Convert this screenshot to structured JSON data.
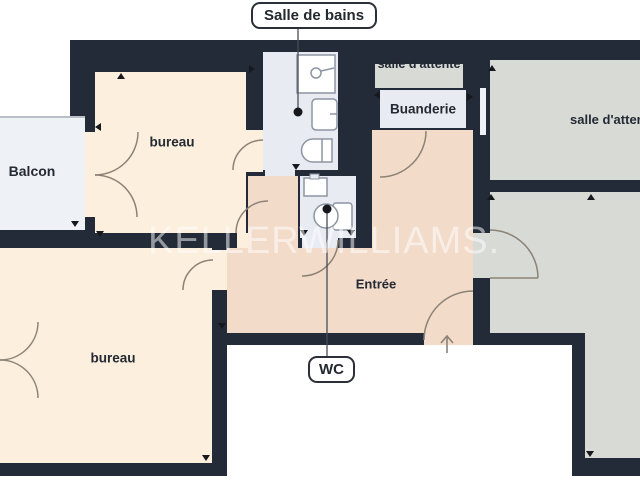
{
  "floorplan": {
    "watermark": "KELLERWILLIAMS.",
    "callouts": {
      "salle_de_bains": "Salle de bains",
      "wc": "WC"
    },
    "rooms": {
      "bureau_top": "bureau",
      "bureau_bottom": "bureau",
      "balcon": "Balcon",
      "buanderie": "Buanderie",
      "salle_attente_strip": "salle d'attente",
      "salle_attente_right": "salle d'attente",
      "entree": "Entrée"
    },
    "icons": {
      "shower": "shower-icon",
      "washbasin": "washbasin-icon",
      "bathtub": "bathtub-icon",
      "toilet": "toilet-icon",
      "sink": "sink-icon",
      "entry_arrow": "entry-arrow-icon"
    },
    "colors": {
      "wall": "#222b37",
      "room_cream": "#fcefdd",
      "room_peach": "#f3dbca",
      "room_blue_gray": "#e8ebf1",
      "room_gray": "#d8dad6",
      "balcony": "#eef1f5",
      "door_line": "#8c8377",
      "label_text": "#242a33",
      "watermark_color": "#ffffff"
    }
  }
}
